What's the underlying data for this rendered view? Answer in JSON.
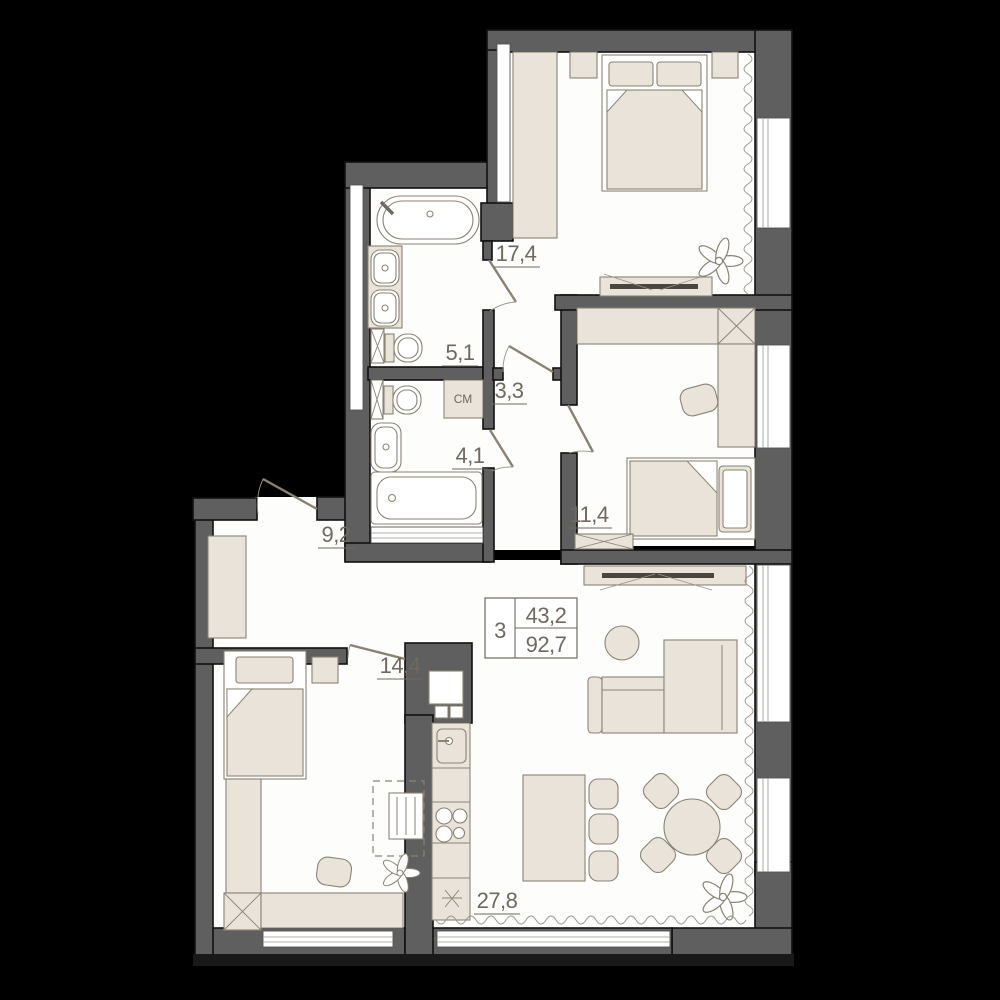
{
  "plan": {
    "type": "apartment-floor-plan",
    "info_box": {
      "rooms_count": "3",
      "living_area": "43,2",
      "total_area": "92,7"
    },
    "room_labels": {
      "bedroom_master": "17,4",
      "bathroom": "5,1",
      "hall_small": "3,3",
      "wc": "4,1",
      "hallway": "9,2",
      "bedroom_second": "11,4",
      "bedroom_third": "14,4",
      "kitchen_living": "27,8"
    },
    "appliance_labels": {
      "washing_machine": "СМ"
    },
    "colors": {
      "background": "#000000",
      "wall": "#5f5f5f",
      "floor": "#ffffff",
      "furniture": "#e9e3da",
      "line": "#8a8374",
      "text": "#6f695f"
    }
  }
}
